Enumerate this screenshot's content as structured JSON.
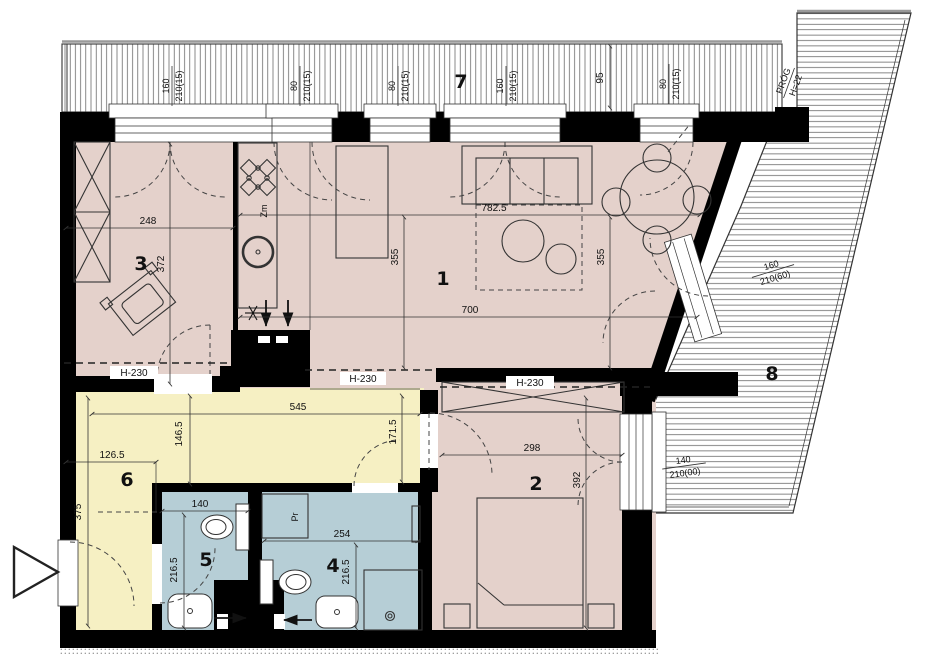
{
  "rooms": {
    "living": "1",
    "bedroom": "2",
    "room3": "3",
    "bathroom": "4",
    "wc": "5",
    "hall": "6",
    "balcony": "7",
    "terrace": "8"
  },
  "dims": {
    "room3_w": "248",
    "room3_h": "372",
    "living_top": "782.5",
    "living_left": "355",
    "living_right": "355",
    "living_mid": "700",
    "bedroom_w": "298",
    "bedroom_h": "392",
    "hall_top": "545",
    "hall_mid": "146.5",
    "hall_left": "126.5",
    "hall_height": "375",
    "hall_door": "171.5",
    "wc_w": "140",
    "wc_h": "216.5",
    "bath_w": "254",
    "bath_h": "216.5",
    "balcony_pier": "95"
  },
  "heights": {
    "h230": "H-230"
  },
  "windows": {
    "w1": {
      "num": "160",
      "type": "210(15)"
    },
    "w2": {
      "num": "80",
      "type": "210(15)"
    },
    "w3": {
      "num": "80",
      "type": "210(15)"
    },
    "w4": {
      "num": "160",
      "type": "210(15)"
    },
    "w5": {
      "num": "80",
      "type": "210(15)"
    },
    "balcony_door": {
      "num": "160",
      "type": "210(60)"
    },
    "bedroom_window": {
      "num": "140",
      "type": "210(00)"
    }
  },
  "threshold": {
    "line1": "PRÓG",
    "line2": "H=22"
  },
  "fixtures": {
    "kitchen_sink": "Zm",
    "washer": "Pr"
  },
  "colors": {
    "room_fill": "#e4d1cb",
    "hall_fill": "#f6f0c3",
    "bath_fill": "#b6ced6",
    "wall": "#000000",
    "line_dark": "#333333",
    "hatch": "#555555"
  }
}
